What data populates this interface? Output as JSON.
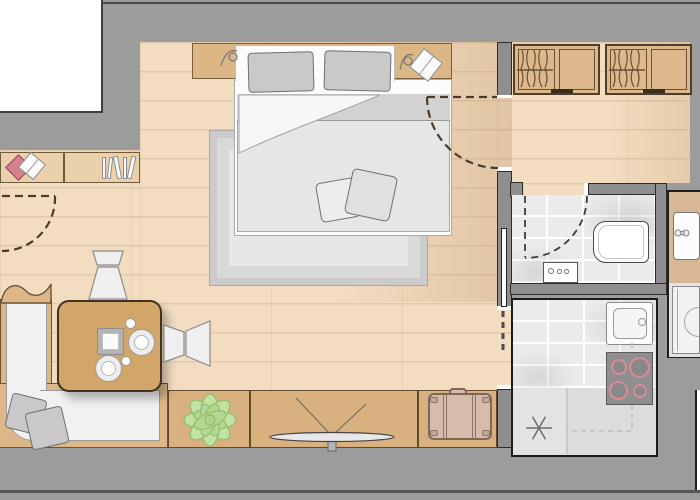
{
  "plan_title": "Studio apartment floor plan",
  "palette": {
    "wall_gray": "#9c9c9c",
    "wall_outline": "#2c2c2c",
    "exterior_white": "#ffffff",
    "floor_wood": "#f2ddc1",
    "plank_line": "#d9bd9a",
    "furniture_wood": "#d9b17e",
    "wood_outline": "#61492e",
    "textile_gray": "#c9c9c9",
    "fixture_white": "#fbfbfb",
    "tile_gray": "#ebebeb",
    "stove_gray": "#8f8f8f",
    "burner_ring": "#dc8a96",
    "plant_green": "#c2e2a4",
    "plant_outline": "#8fbe6d",
    "suitcase_tan": "#d6bcab",
    "accent_red": "#d5808d",
    "door_dash": "#4d3b2a"
  },
  "rooms": {
    "living_bedroom": {
      "label": "Living / bedroom area"
    },
    "hallway": {
      "label": "Hallway with wardrobes"
    },
    "bathroom": {
      "label": "Bathroom"
    },
    "utility": {
      "label": "Vanity and bathtub strip"
    },
    "kitchen": {
      "label": "Kitchen"
    }
  },
  "furniture": {
    "bed": {
      "label": "Double bed with two pillows and folded duvet"
    },
    "rug": {
      "label": "Large area rug under bed"
    },
    "headboard": {
      "label": "Headboard shelf with wall lamps and book"
    },
    "wardrobe1": {
      "label": "Wardrobe unit with hanging clothes"
    },
    "wardrobe2": {
      "label": "Wardrobe unit with hanging clothes"
    },
    "wall_shelf": {
      "label": "Wall shelf with books"
    },
    "sofa": {
      "label": "L-shaped corner sofa with two cushions"
    },
    "table": {
      "label": "Dining table with tray, plates and cups"
    },
    "chair_top": {
      "label": "Chair"
    },
    "chair_right": {
      "label": "Chair"
    },
    "plant_cabinet": {
      "label": "Sideboard with plant"
    },
    "tv_cabinet": {
      "label": "Sideboard with TV"
    },
    "suitcase_cabinet": {
      "label": "Cabinet with suitcase"
    },
    "toilet": {
      "label": "Wall-hung toilet"
    },
    "washer": {
      "label": "Washing machine"
    },
    "vanity": {
      "label": "Vanity sink"
    },
    "bathtub": {
      "label": "Bathtub"
    },
    "kitchen_sink": {
      "label": "Kitchen sink"
    },
    "cooktop": {
      "label": "Cooktop with 4 burners"
    },
    "ceiling_light": {
      "label": "Ceiling light symbol"
    },
    "entry_door": {
      "label": "Entry door swing"
    },
    "bedroom_door": {
      "label": "Bedroom door swing"
    },
    "bathroom_door": {
      "label": "Bathroom door swing"
    },
    "pocket_door": {
      "label": "Sliding pocket door to kitchen"
    }
  },
  "counts": {
    "burners": 4,
    "wardrobe_units": 2,
    "bed_pillows": 2,
    "sofa_cushions": 2,
    "chairs": 2
  }
}
